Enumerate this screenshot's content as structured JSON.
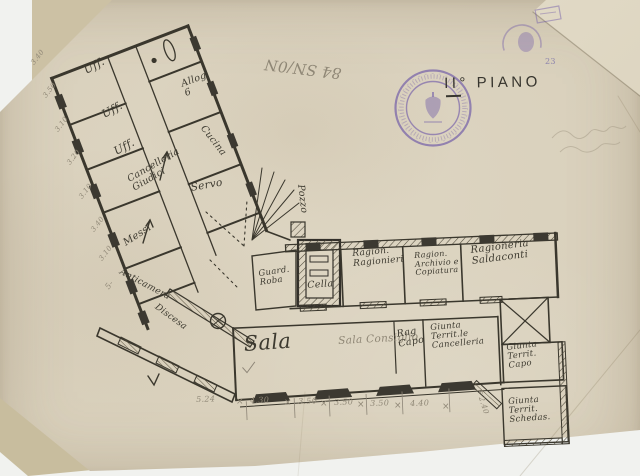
{
  "title": {
    "floor_label": "II° PIANO"
  },
  "notes": {
    "archive_number": "84 SN/0N",
    "corner_number": "23",
    "discesa": "Discesa",
    "pozzo": "Pozzo"
  },
  "rooms": {
    "uff1": "Uff.",
    "uff2": "Uff.",
    "uff3": "Uff.",
    "alloggio": "Allog.\n6",
    "cucina": "Cucina",
    "cancelleria_giudici": "Cancelleria\nGiudici",
    "messi": "Messi",
    "servo": "Servo",
    "anticamera": "Anticamera",
    "guardaroba": "Guard.\nRoba",
    "cella": "Cella",
    "ragion_ragionieri": "Ragion.\nRagionieri",
    "ragion_archivio": "Ragion.\nArchivio e\nCopiatura",
    "ragioneria_saldaconti": "Ragioneria\nSaldaconti",
    "sala": "Sala",
    "sala_pencil": "Sala Consiglio",
    "rag_capo": "Rag\nCapo",
    "giunta_cancelleria": "Giunta\nTerrit.le\nCancelleria",
    "giunta_capo": "Giunta\nTerrit.\nCapo",
    "giunta_schede": "Giunta\nTerrit.\nSchedas."
  },
  "dimensions": {
    "bottom": [
      "5.24",
      "4.30",
      "3.50",
      "3.50",
      "3.50",
      "4.40"
    ],
    "left": [
      "3.40",
      "3.50",
      "3.10",
      "3.20",
      "3.10",
      "3.40",
      "3.10",
      "5-"
    ],
    "right_vertical": "F 2.40",
    "mark": "×"
  }
}
